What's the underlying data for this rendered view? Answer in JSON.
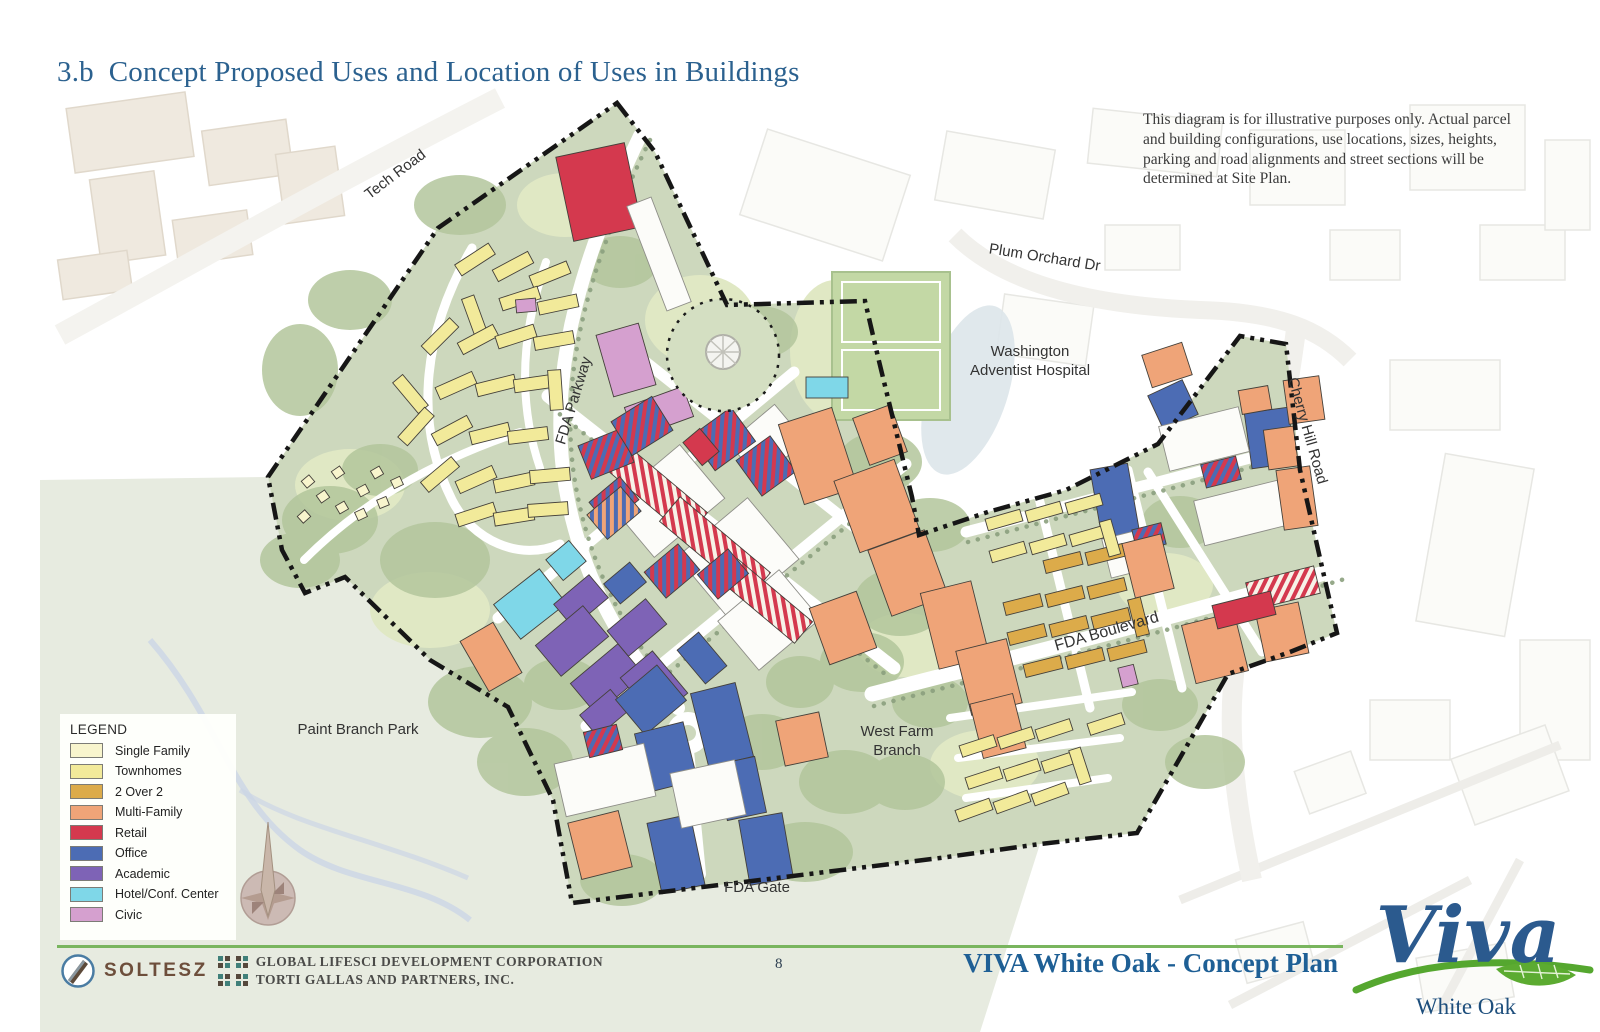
{
  "page": {
    "title": "3.b  Concept Proposed Uses and Location of Uses in Buildings"
  },
  "disclaimer": "This diagram is for illustrative purposes only.  Actual parcel and building configurations, use locations, sizes, heights, parking and road alignments and street sections will be determined at Site Plan.",
  "legend": {
    "title": "LEGEND",
    "items": [
      {
        "label": "Single Family",
        "color": "#f8f5cd"
      },
      {
        "label": "Townhomes",
        "color": "#f2ea9a"
      },
      {
        "label": "2 Over 2",
        "color": "#dcab4a"
      },
      {
        "label": "Multi-Family",
        "color": "#efa478"
      },
      {
        "label": "Retail",
        "color": "#d4394e"
      },
      {
        "label": "Office",
        "color": "#4c6cb4"
      },
      {
        "label": "Academic",
        "color": "#7e63b6"
      },
      {
        "label": "Hotel/Conf. Center",
        "color": "#7fd7e8"
      },
      {
        "label": "Civic",
        "color": "#d5a0cf"
      }
    ]
  },
  "map": {
    "site_color": "#cdd8bd",
    "boundary_color": "#161616",
    "labels": [
      {
        "id": "tech-road",
        "text": "Tech Road",
        "x": 398,
        "y": 178,
        "r": -37,
        "size": 15
      },
      {
        "id": "fda-parkway",
        "text": "FDA Parkway",
        "x": 578,
        "y": 402,
        "r": -73,
        "size": 15
      },
      {
        "id": "plum-orchard-dr",
        "text": "Plum Orchard Dr",
        "x": 1044,
        "y": 262,
        "r": 9,
        "size": 15
      },
      {
        "id": "washington-adventist-hospital",
        "lines": [
          "Washington",
          "Adventist Hospital"
        ],
        "x": 1030,
        "y": 356,
        "r": 0,
        "size": 15
      },
      {
        "id": "cherry-hill-road",
        "text": "Cherry Hill Road",
        "x": 1303,
        "y": 432,
        "r": 74,
        "size": 15
      },
      {
        "id": "fda-boulevard",
        "text": "FDA Boulevard",
        "x": 1108,
        "y": 636,
        "r": -16,
        "size": 16
      },
      {
        "id": "west-farm-branch",
        "lines": [
          "West Farm",
          "Branch"
        ],
        "x": 897,
        "y": 736,
        "r": 0,
        "size": 15
      },
      {
        "id": "fda-gate",
        "text": "FDA Gate",
        "x": 757,
        "y": 892,
        "r": 0,
        "size": 15
      },
      {
        "id": "paint-branch-park",
        "text": "Paint Branch Park",
        "x": 358,
        "y": 734,
        "r": 0,
        "size": 15
      }
    ],
    "building_types": {
      "sf": "#f8f5cd",
      "th": "#f2ea9a",
      "o2": "#dcab4a",
      "mf": "#efa478",
      "rt": "#d4394e",
      "of": "#4c6cb4",
      "ac": "#7e63b6",
      "ho": "#7fd7e8",
      "cv": "#d5a0cf",
      "wh": "#fcfcf9"
    },
    "stripe_types": {
      "srb": [
        "#d4394e",
        "#4c6cb4"
      ],
      "srw": [
        "#d4394e",
        "#f7f2e8"
      ],
      "sob": [
        "#efa478",
        "#4c6cb4"
      ]
    },
    "buildings": [
      [
        455,
        253,
        40,
        13,
        -33,
        "th"
      ],
      [
        493,
        260,
        40,
        13,
        -28,
        "th"
      ],
      [
        530,
        268,
        40,
        13,
        -22,
        "th"
      ],
      [
        468,
        296,
        13,
        40,
        -20,
        "th"
      ],
      [
        500,
        292,
        40,
        13,
        -18,
        "th"
      ],
      [
        538,
        298,
        40,
        13,
        -12,
        "th"
      ],
      [
        420,
        330,
        40,
        13,
        -45,
        "th"
      ],
      [
        458,
        333,
        40,
        13,
        -28,
        "th"
      ],
      [
        496,
        330,
        40,
        13,
        -18,
        "th"
      ],
      [
        534,
        334,
        40,
        13,
        -10,
        "th"
      ],
      [
        404,
        374,
        13,
        40,
        -40,
        "th"
      ],
      [
        436,
        379,
        40,
        13,
        -24,
        "th"
      ],
      [
        476,
        379,
        40,
        13,
        -14,
        "th"
      ],
      [
        514,
        377,
        40,
        13,
        -8,
        "th"
      ],
      [
        549,
        370,
        13,
        40,
        -4,
        "th"
      ],
      [
        396,
        420,
        40,
        13,
        -48,
        "th"
      ],
      [
        432,
        424,
        40,
        13,
        -28,
        "th"
      ],
      [
        470,
        427,
        40,
        13,
        -14,
        "th"
      ],
      [
        508,
        429,
        40,
        13,
        -7,
        "th"
      ],
      [
        420,
        468,
        40,
        13,
        -40,
        "th"
      ],
      [
        456,
        473,
        40,
        13,
        -24,
        "th"
      ],
      [
        494,
        476,
        40,
        13,
        -12,
        "th"
      ],
      [
        530,
        469,
        40,
        13,
        -5,
        "th"
      ],
      [
        456,
        508,
        40,
        13,
        -18,
        "th"
      ],
      [
        494,
        510,
        40,
        13,
        -9,
        "th"
      ],
      [
        528,
        503,
        40,
        13,
        -4,
        "th"
      ],
      [
        303,
        477,
        10,
        9,
        -40,
        "sf"
      ],
      [
        318,
        492,
        10,
        9,
        -35,
        "sf"
      ],
      [
        337,
        503,
        10,
        9,
        -30,
        "sf"
      ],
      [
        356,
        510,
        10,
        9,
        -25,
        "sf"
      ],
      [
        299,
        512,
        10,
        9,
        -42,
        "sf"
      ],
      [
        333,
        468,
        10,
        9,
        -35,
        "sf"
      ],
      [
        358,
        486,
        10,
        9,
        -28,
        "sf"
      ],
      [
        378,
        498,
        10,
        9,
        -22,
        "sf"
      ],
      [
        372,
        468,
        10,
        9,
        -30,
        "sf"
      ],
      [
        392,
        478,
        10,
        9,
        -25,
        "sf"
      ],
      [
        564,
        149,
        70,
        86,
        -12,
        "rt"
      ],
      [
        646,
        198,
        26,
        112,
        -21,
        "wh"
      ],
      [
        604,
        328,
        44,
        64,
        -16,
        "cv"
      ],
      [
        628,
        396,
        62,
        32,
        -20,
        "cv"
      ],
      [
        516,
        299,
        20,
        13,
        -5,
        "cv"
      ],
      [
        806,
        377,
        42,
        21,
        0,
        "ho"
      ],
      [
        551,
        547,
        30,
        27,
        -40,
        "ho"
      ],
      [
        501,
        582,
        58,
        44,
        -38,
        "ho"
      ],
      [
        558,
        586,
        46,
        30,
        -40,
        "ac"
      ],
      [
        541,
        621,
        62,
        40,
        -40,
        "ac"
      ],
      [
        576,
        659,
        62,
        40,
        -40,
        "ac"
      ],
      [
        612,
        611,
        50,
        33,
        -40,
        "ac"
      ],
      [
        633,
        658,
        42,
        55,
        -40,
        "ac"
      ],
      [
        584,
        699,
        40,
        28,
        -40,
        "ac"
      ],
      [
        688,
        636,
        28,
        44,
        -40,
        "of"
      ],
      [
        624,
        677,
        54,
        46,
        -40,
        "of"
      ],
      [
        641,
        727,
        50,
        60,
        -14,
        "of"
      ],
      [
        699,
        687,
        46,
        76,
        -14,
        "of"
      ],
      [
        721,
        760,
        40,
        57,
        -12,
        "of"
      ],
      [
        654,
        818,
        44,
        72,
        -12,
        "of"
      ],
      [
        744,
        816,
        44,
        66,
        -10,
        "of"
      ],
      [
        608,
        570,
        34,
        26,
        -40,
        "of"
      ],
      [
        1096,
        466,
        38,
        72,
        -10,
        "of"
      ],
      [
        1248,
        410,
        44,
        56,
        -8,
        "of"
      ],
      [
        1154,
        386,
        38,
        38,
        -25,
        "of"
      ],
      [
        621,
        466,
        92,
        70,
        -40,
        "wh"
      ],
      [
        692,
        518,
        92,
        80,
        -40,
        "wh"
      ],
      [
        737,
        418,
        60,
        48,
        -40,
        "wh"
      ],
      [
        729,
        588,
        80,
        64,
        -40,
        "wh"
      ],
      [
        559,
        753,
        92,
        54,
        -13,
        "wh"
      ],
      [
        675,
        766,
        66,
        56,
        -12,
        "wh"
      ],
      [
        1163,
        416,
        82,
        46,
        -14,
        "wh"
      ],
      [
        1198,
        490,
        86,
        46,
        -14,
        "wh"
      ],
      [
        1106,
        534,
        38,
        40,
        -14,
        "wh"
      ],
      [
        636,
        428,
        32,
        118,
        -50,
        "srw"
      ],
      [
        699,
        488,
        32,
        118,
        -50,
        "srw"
      ],
      [
        752,
        552,
        28,
        98,
        -50,
        "srw"
      ],
      [
        1248,
        574,
        70,
        28,
        -14,
        "srw"
      ],
      [
        583,
        436,
        46,
        36,
        -22,
        "srb"
      ],
      [
        618,
        406,
        48,
        40,
        -32,
        "srb"
      ],
      [
        698,
        418,
        50,
        42,
        -36,
        "srb"
      ],
      [
        745,
        444,
        42,
        44,
        -36,
        "srb"
      ],
      [
        594,
        486,
        40,
        30,
        -40,
        "srb"
      ],
      [
        650,
        554,
        44,
        34,
        -40,
        "srb"
      ],
      [
        703,
        558,
        40,
        32,
        -40,
        "srb"
      ],
      [
        1203,
        460,
        36,
        24,
        -14,
        "srb"
      ],
      [
        1134,
        526,
        30,
        22,
        -14,
        "srb"
      ],
      [
        586,
        728,
        34,
        26,
        -14,
        "srb"
      ],
      [
        592,
        497,
        44,
        32,
        -40,
        "sob"
      ],
      [
        790,
        414,
        56,
        84,
        -18,
        "mf"
      ],
      [
        845,
        468,
        64,
        76,
        -20,
        "mf"
      ],
      [
        878,
        538,
        60,
        70,
        -20,
        "mf"
      ],
      [
        818,
        598,
        50,
        60,
        -20,
        "mf"
      ],
      [
        929,
        586,
        52,
        78,
        -14,
        "mf"
      ],
      [
        963,
        644,
        52,
        66,
        -14,
        "mf"
      ],
      [
        976,
        698,
        44,
        56,
        -14,
        "mf"
      ],
      [
        780,
        716,
        44,
        46,
        -12,
        "mf"
      ],
      [
        574,
        816,
        52,
        58,
        -14,
        "mf"
      ],
      [
        472,
        628,
        38,
        58,
        -30,
        "mf"
      ],
      [
        860,
        410,
        40,
        50,
        -20,
        "mf"
      ],
      [
        1286,
        378,
        36,
        44,
        -8,
        "mf"
      ],
      [
        1146,
        348,
        42,
        34,
        -18,
        "mf"
      ],
      [
        1266,
        428,
        30,
        40,
        -8,
        "mf"
      ],
      [
        1280,
        468,
        34,
        60,
        -8,
        "mf"
      ],
      [
        1188,
        618,
        54,
        60,
        -14,
        "mf"
      ],
      [
        1260,
        606,
        44,
        52,
        -12,
        "mf"
      ],
      [
        1128,
        538,
        40,
        56,
        -14,
        "mf"
      ],
      [
        1240,
        388,
        30,
        24,
        -10,
        "mf"
      ],
      [
        1214,
        598,
        60,
        24,
        -14,
        "rt"
      ],
      [
        690,
        432,
        22,
        30,
        -40,
        "rt"
      ],
      [
        1004,
        598,
        38,
        13,
        -14,
        "o2"
      ],
      [
        1046,
        590,
        38,
        13,
        -14,
        "o2"
      ],
      [
        1088,
        582,
        38,
        13,
        -14,
        "o2"
      ],
      [
        1008,
        628,
        38,
        13,
        -14,
        "o2"
      ],
      [
        1050,
        620,
        38,
        13,
        -14,
        "o2"
      ],
      [
        1092,
        612,
        38,
        13,
        -14,
        "o2"
      ],
      [
        1024,
        660,
        38,
        13,
        -14,
        "o2"
      ],
      [
        1066,
        652,
        38,
        13,
        -14,
        "o2"
      ],
      [
        1108,
        644,
        38,
        13,
        -14,
        "o2"
      ],
      [
        1132,
        598,
        13,
        38,
        -14,
        "o2"
      ],
      [
        1044,
        556,
        38,
        13,
        -14,
        "o2"
      ],
      [
        1086,
        548,
        38,
        13,
        -14,
        "o2"
      ],
      [
        986,
        514,
        36,
        12,
        -16,
        "th"
      ],
      [
        1026,
        506,
        36,
        12,
        -16,
        "th"
      ],
      [
        1066,
        498,
        36,
        12,
        -16,
        "th"
      ],
      [
        990,
        546,
        36,
        12,
        -16,
        "th"
      ],
      [
        1030,
        538,
        36,
        12,
        -16,
        "th"
      ],
      [
        1070,
        530,
        36,
        12,
        -16,
        "th"
      ],
      [
        1104,
        520,
        12,
        36,
        -16,
        "th"
      ],
      [
        960,
        740,
        36,
        12,
        -18,
        "th"
      ],
      [
        998,
        732,
        36,
        12,
        -18,
        "th"
      ],
      [
        1036,
        724,
        36,
        12,
        -18,
        "th"
      ],
      [
        966,
        772,
        36,
        12,
        -18,
        "th"
      ],
      [
        1004,
        764,
        36,
        12,
        -18,
        "th"
      ],
      [
        1042,
        756,
        36,
        12,
        -18,
        "th"
      ],
      [
        956,
        804,
        36,
        12,
        -20,
        "th"
      ],
      [
        994,
        796,
        36,
        12,
        -20,
        "th"
      ],
      [
        1032,
        788,
        36,
        12,
        -20,
        "th"
      ],
      [
        1074,
        748,
        12,
        36,
        -18,
        "th"
      ],
      [
        1088,
        718,
        36,
        12,
        -18,
        "th"
      ],
      [
        1120,
        666,
        16,
        20,
        -14,
        "cv"
      ]
    ]
  },
  "footer": {
    "soltesz": "SOLTESZ",
    "company_line1": "GLOBAL LIFESCI DEVELOPMENT CORPORATION",
    "company_line2": "TORTI GALLAS AND PARTNERS, INC.",
    "page_number": "8",
    "plan_title": "VIVA White Oak - Concept Plan",
    "logo_title": "Viva",
    "logo_subtitle": "White Oak"
  }
}
